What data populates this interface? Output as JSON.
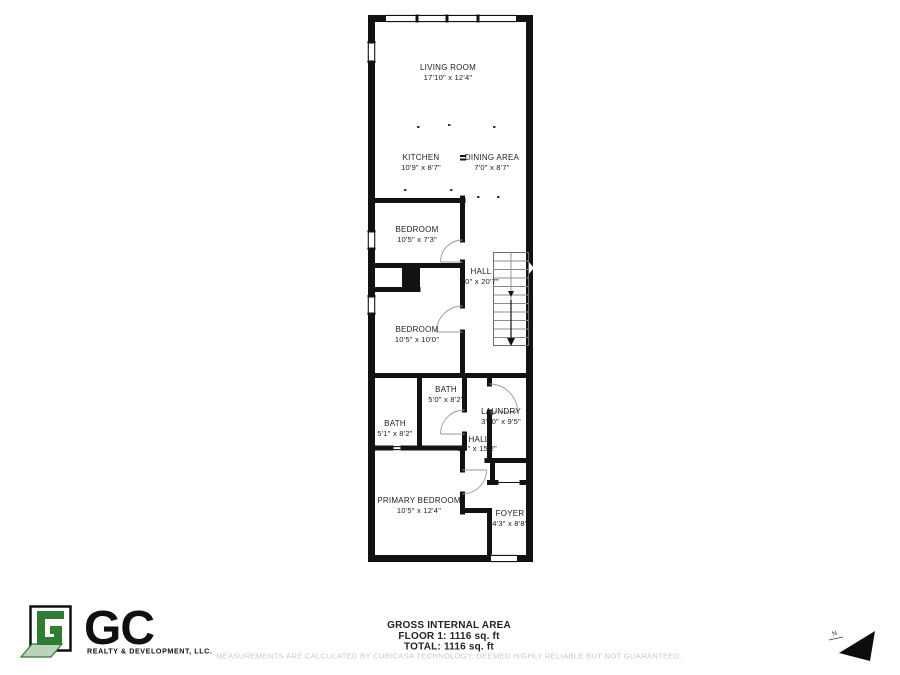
{
  "floorplan": {
    "rooms": [
      {
        "name": "LIVING ROOM",
        "dims": "17'10\" x 12'4\""
      },
      {
        "name": "KITCHEN",
        "dims": "10'9\" x 8'7\""
      },
      {
        "name": "DINING AREA",
        "dims": "7'0\" x 8'7\""
      },
      {
        "name": "BEDROOM",
        "dims": "10'5\" x 7'3\""
      },
      {
        "name": "HALL",
        "dims": "7'0\" x 20'7\""
      },
      {
        "name": "BEDROOM",
        "dims": "10'5\" x 10'0\""
      },
      {
        "name": "BATH",
        "dims": "5'0\" x 8'2\""
      },
      {
        "name": "BATH",
        "dims": "5'1\" x 8'2\""
      },
      {
        "name": "LAUNDRY",
        "dims": "3'10\" x 9'5\""
      },
      {
        "name": "HALL",
        "dims": "3'0\" x 15'2\""
      },
      {
        "name": "PRIMARY BEDROOM",
        "dims": "10'5\" x 12'4\""
      },
      {
        "name": "FOYER",
        "dims": "4'3\" x 8'8\""
      }
    ]
  },
  "summary": {
    "title": "GROSS INTERNAL AREA",
    "floor": "FLOOR 1: 1116 sq. ft",
    "total": "TOTAL: 1116 sq. ft",
    "disclaimer": "MEASUREMENTS ARE CALCULATED BY CUBICASA TECHNOLOGY. DEEMED HIGHLY RELIABLE BUT NOT GUARANTEED."
  },
  "branding": {
    "initials": "GC",
    "company": "REALTY & DEVELOPMENT, LLC.",
    "accent_green": "#2e7d32",
    "light_green": "#b9d4b9"
  },
  "compass": {
    "label": "N"
  }
}
